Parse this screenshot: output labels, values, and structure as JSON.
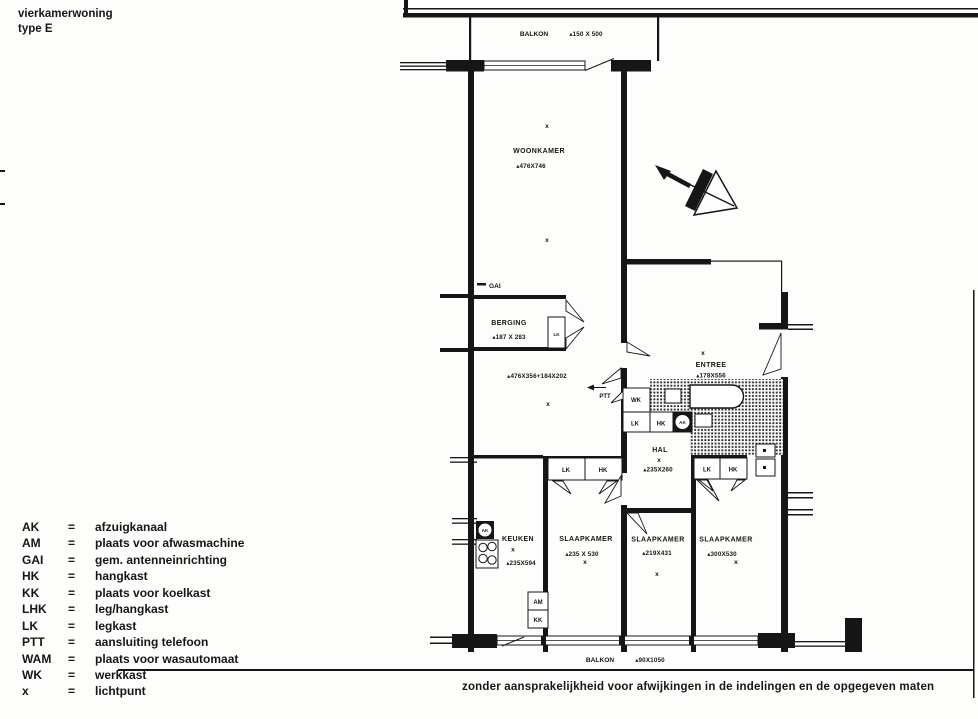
{
  "header": {
    "title": "vierkamerwoning",
    "type": "type E"
  },
  "legend": {
    "eq": "=",
    "items": [
      {
        "abbr": "AK",
        "desc": "afzuigkanaal"
      },
      {
        "abbr": "AM",
        "desc": "plaats voor afwasmachine"
      },
      {
        "abbr": "GAI",
        "desc": "gem. antenneinrichting"
      },
      {
        "abbr": "HK",
        "desc": "hangkast"
      },
      {
        "abbr": "KK",
        "desc": "plaats voor koelkast"
      },
      {
        "abbr": "LHK",
        "desc": "leg/hangkast"
      },
      {
        "abbr": "LK",
        "desc": "legkast"
      },
      {
        "abbr": "PTT",
        "desc": "aansluiting telefoon"
      },
      {
        "abbr": "WAM",
        "desc": "plaats voor wasautomaat"
      },
      {
        "abbr": "WK",
        "desc": "werkkast"
      },
      {
        "abbr": "x",
        "desc": "lichtpunt"
      }
    ]
  },
  "rooms": {
    "balkon_top": {
      "label": "BALKON",
      "dim": "▴150 X 500"
    },
    "woonkamer": {
      "label": "WOONKAMER",
      "dim": "▴476X746"
    },
    "berging": {
      "label": "BERGING",
      "dim": "▴187 X 283"
    },
    "woonkamer_extra_dim": "▴476X356+184X202",
    "entree": {
      "label": "ENTREE",
      "dim": "▴178X556"
    },
    "hal": {
      "label": "HAL",
      "dim": "▴235X260"
    },
    "keuken": {
      "label": "KEUKEN",
      "dim": "▴235X594"
    },
    "slaapkamer1": {
      "label": "SLAAPKAMER",
      "dim": "▴235 X 530"
    },
    "slaapkamer2": {
      "label": "SLAAPKAMER",
      "dim": "▴219X431"
    },
    "slaapkamer3": {
      "label": "SLAAPKAMER",
      "dim": "▴300X530"
    },
    "balkon_bottom": {
      "label": "BALKON",
      "dim": "▴90X1050"
    }
  },
  "markers": {
    "gai": "GAI",
    "ptt": "PTT",
    "wk": "WK",
    "lk": "LK",
    "hk": "HK",
    "ak": "AK",
    "am": "AM",
    "kk": "KK",
    "lightpoint": "x"
  },
  "footer": {
    "disclaimer": "zonder aansprakelijkheid voor afwijkingen in de indelingen en de opgegeven maten"
  },
  "ink_color": "#161616"
}
